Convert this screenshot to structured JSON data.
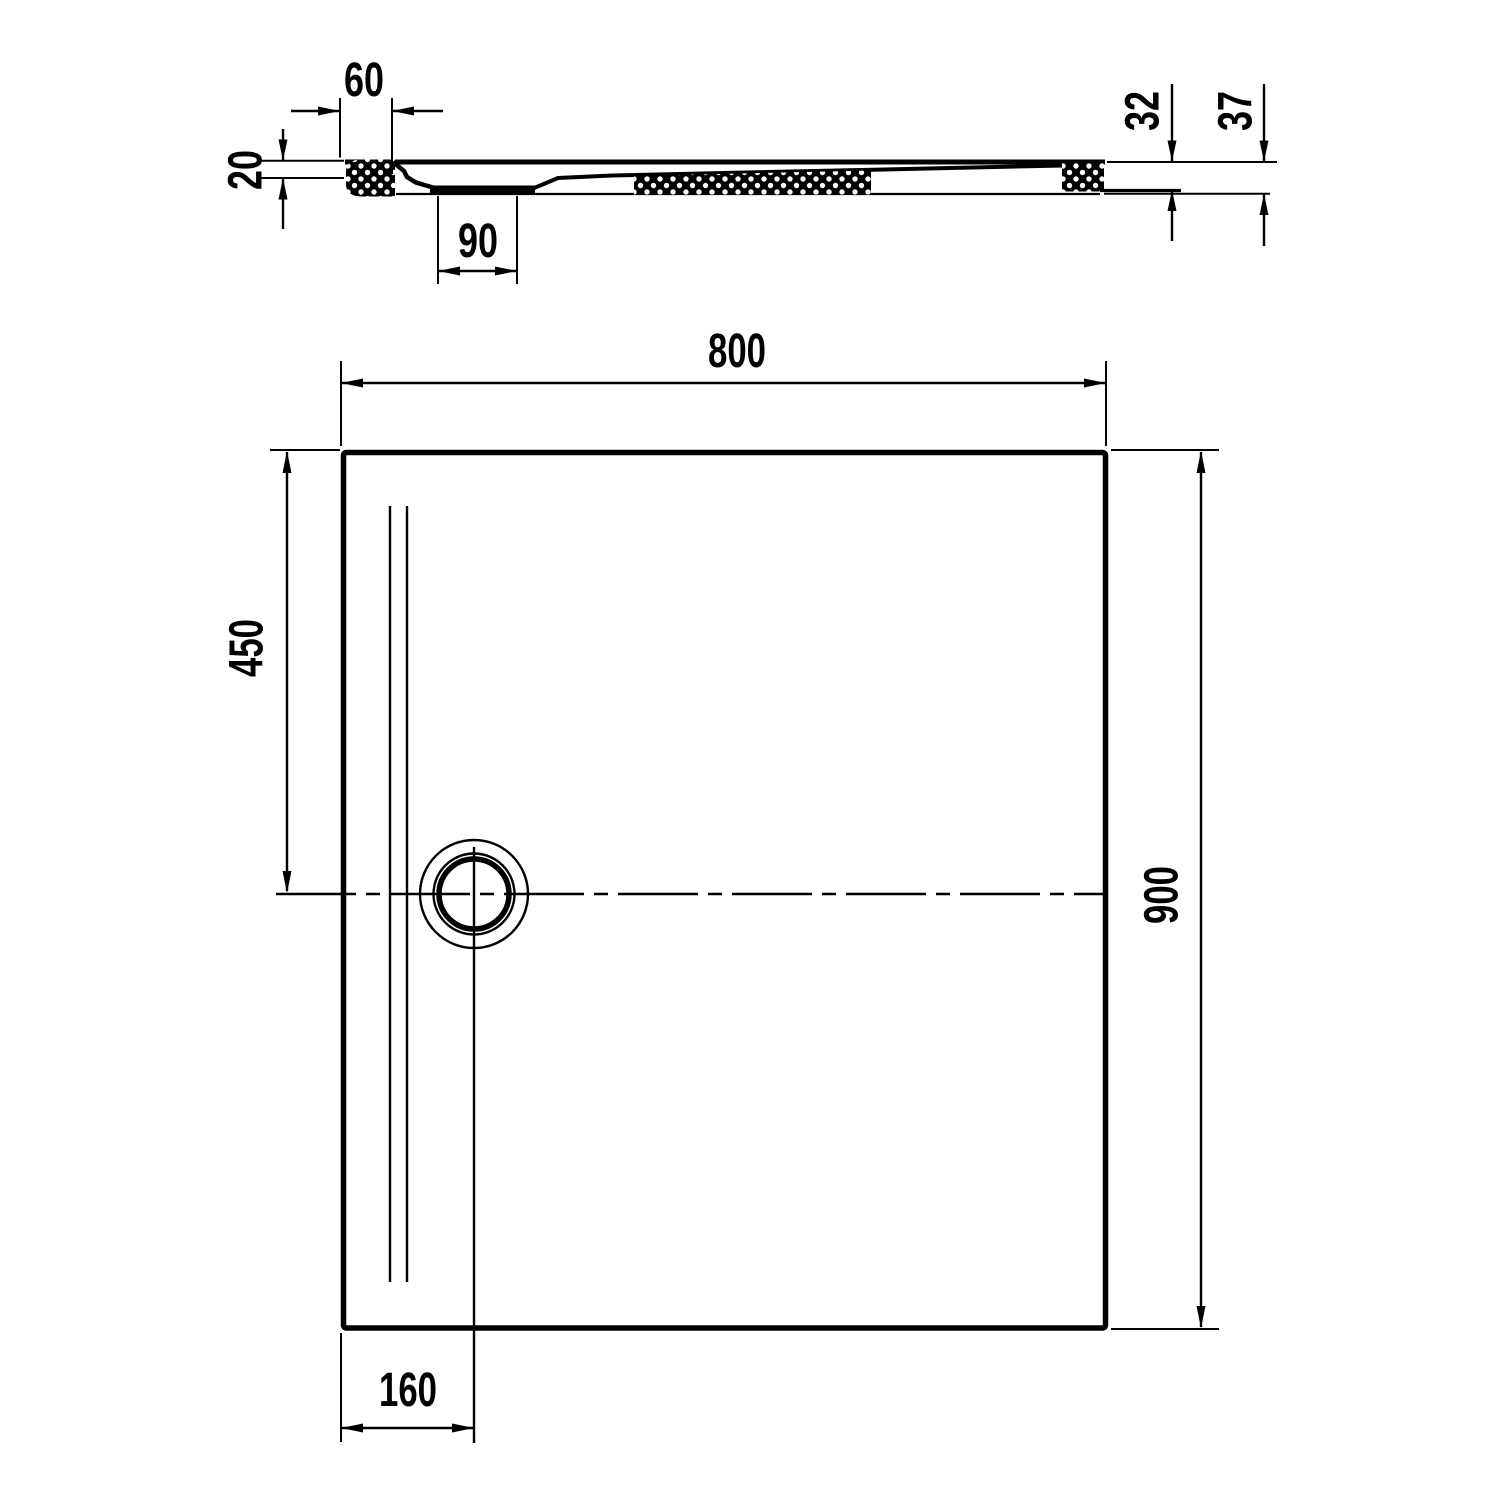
{
  "canvas": {
    "background": "#ffffff",
    "line_color": "#000000",
    "description": "Technical dimension drawing of a rectangular shower tray: section view on top, plan view below"
  },
  "section_view": {
    "flange_width_mm": "60",
    "rim_thickness_mm": "20",
    "sump_width_mm": "90",
    "edge_height_mm": "32",
    "total_height_mm": "37"
  },
  "plan_view": {
    "width_mm": "800",
    "depth_mm": "900",
    "drain_offset_from_top_mm": "450",
    "drain_offset_from_left_mm": "160"
  }
}
